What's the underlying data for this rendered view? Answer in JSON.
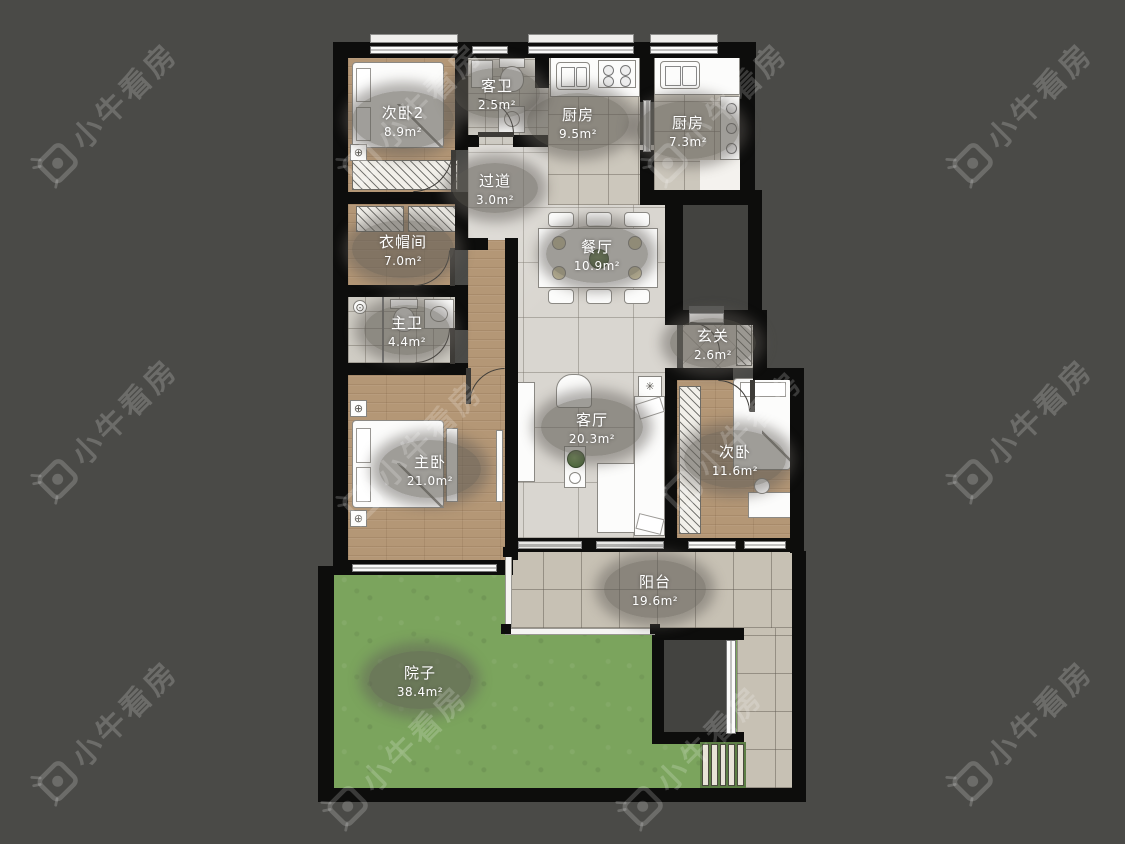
{
  "watermark": {
    "text": "小牛看房"
  },
  "rooms": [
    {
      "id": "bedroom2",
      "name": "次卧2",
      "area": "8.9m²"
    },
    {
      "id": "guest_bath",
      "name": "客卫",
      "area": "2.5m²"
    },
    {
      "id": "kitchen_a",
      "name": "厨房",
      "area": "9.5m²"
    },
    {
      "id": "kitchen_b",
      "name": "厨房",
      "area": "7.3m²"
    },
    {
      "id": "hallway",
      "name": "过道",
      "area": "3.0m²"
    },
    {
      "id": "cloakroom",
      "name": "衣帽间",
      "area": "7.0m²"
    },
    {
      "id": "dining",
      "name": "餐厅",
      "area": "10.9m²"
    },
    {
      "id": "master_bath",
      "name": "主卫",
      "area": "4.4m²"
    },
    {
      "id": "entry",
      "name": "玄关",
      "area": "2.6m²"
    },
    {
      "id": "master_bedroom",
      "name": "主卧",
      "area": "21.0m²"
    },
    {
      "id": "living",
      "name": "客厅",
      "area": "20.3m²"
    },
    {
      "id": "bedroom",
      "name": "次卧",
      "area": "11.6m²"
    },
    {
      "id": "balcony",
      "name": "阳台",
      "area": "19.6m²"
    },
    {
      "id": "yard",
      "name": "院子",
      "area": "38.4m²"
    }
  ],
  "palette": {
    "background": "#4a4a47",
    "wall": "#0d0d0c",
    "wood_floor": "#b49776",
    "tile_floor": "#d9d6d0",
    "kitchen_tile": "#ccc7bc",
    "balcony_tile": "#c7c1b4",
    "grass": "#7ba45d",
    "label_bubble": "rgba(96,93,87,0.60)",
    "furniture": "#fcfcfb"
  }
}
